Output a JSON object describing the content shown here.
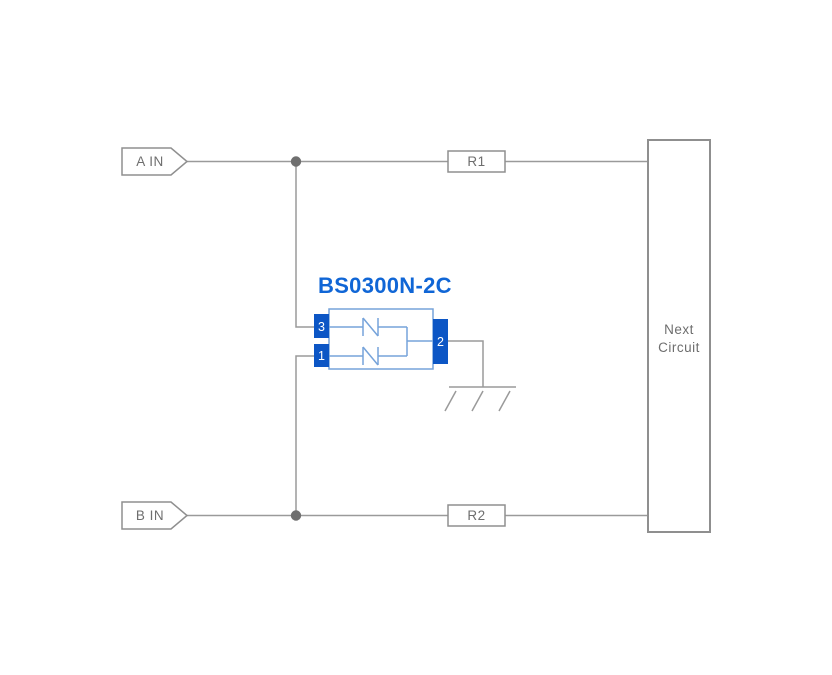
{
  "component": {
    "title": "BS0300N-2C",
    "pins": {
      "pin3": "3",
      "pin1": "1",
      "pin2": "2"
    }
  },
  "inputs": [
    {
      "label": "A IN"
    },
    {
      "label": "B IN"
    }
  ],
  "resistors": [
    {
      "label": "R1"
    },
    {
      "label": "R2"
    }
  ],
  "next_circuit": {
    "line1": "Next",
    "line2": "Circuit"
  },
  "colors": {
    "background": "#ffffff",
    "wire_gray": "#9a9a9a",
    "border_gray": "#8f8f8f",
    "text_gray": "#6e6e6e",
    "junction_gray": "#6f6f6f",
    "pin_blue": "#0c56c5",
    "component_outline_blue": "#76a3da",
    "title_blue": "#1066d6"
  }
}
